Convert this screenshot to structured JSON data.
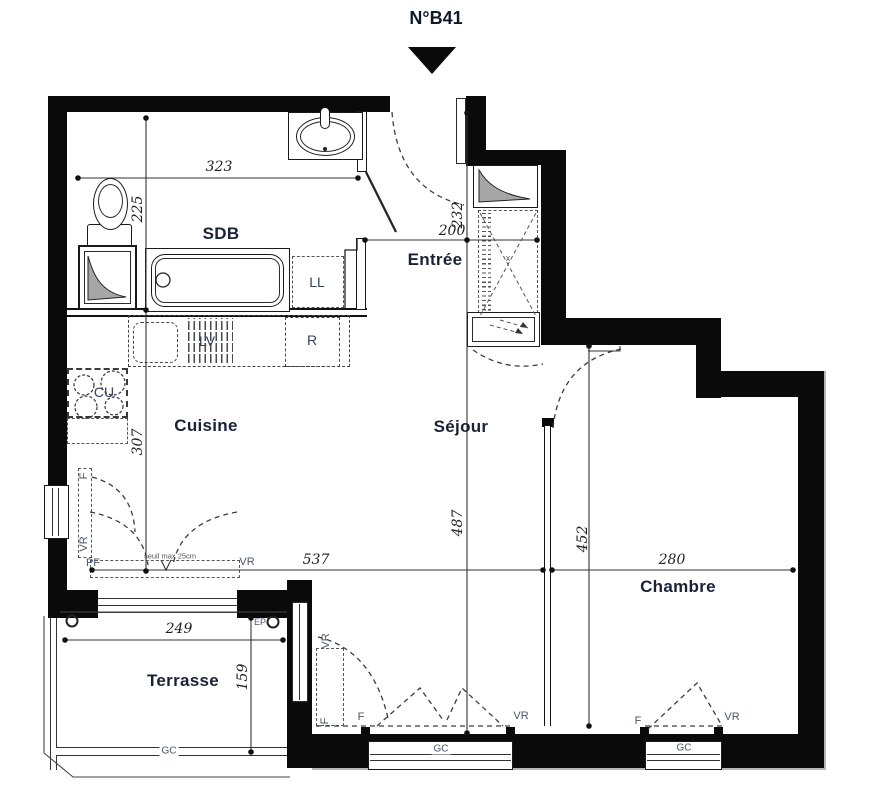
{
  "title": "N°B41",
  "rooms": {
    "sdb": "SDB",
    "entree": "Entrée",
    "cuisine": "Cuisine",
    "sejour": "Séjour",
    "chambre": "Chambre",
    "terrasse": "Terrasse"
  },
  "appliances": {
    "ll": "LL",
    "lv": "LV",
    "r": "R",
    "cu": "CU"
  },
  "dims": {
    "sdb_w": "323",
    "sdb_h": "225",
    "entree_h": "232",
    "entree_w": "200",
    "cuisine_h": "307",
    "sejour_h": "487",
    "chambre_h": "452",
    "sejour_w": "537",
    "chambre_w": "280",
    "terrasse_w": "249",
    "terrasse_h": "159"
  },
  "tags": {
    "f": "F",
    "vr": "VR",
    "pf": "PF",
    "gc": "GC",
    "ep": "EP",
    "x": "x"
  },
  "notes": {
    "seuil": "seuil max 25cm"
  },
  "colors": {
    "wall": "#0a0a0a",
    "room_label": "#1a2238",
    "dimension_text": "#1f1f1f",
    "tag_text": "#4a5568"
  }
}
